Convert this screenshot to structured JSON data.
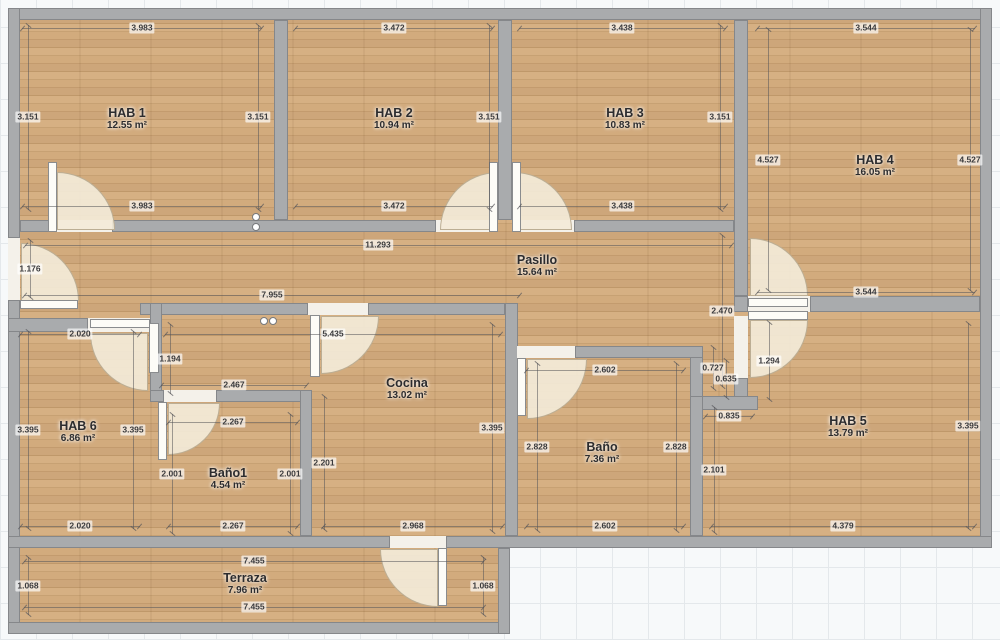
{
  "plan": {
    "title": "Apartment floor plan",
    "units": "m",
    "colors": {
      "wall_gray": "#a9abad",
      "wall_outline": "#85878a",
      "wood_light": "#d6b083",
      "wood_dark": "#bf986a",
      "door_arc_cream": "#f3ead8",
      "grid_line": "#e4e8eb",
      "paper": "#f7f9fa",
      "label_text": "#2c2c2e"
    },
    "rooms": [
      {
        "name": "HAB 1",
        "area": "12.55 m²"
      },
      {
        "name": "HAB 2",
        "area": "10.94 m²"
      },
      {
        "name": "HAB 3",
        "area": "10.83 m²"
      },
      {
        "name": "HAB 4",
        "area": "16.05 m²"
      },
      {
        "name": "Pasillo",
        "area": "15.64 m²"
      },
      {
        "name": "HAB 6",
        "area": "6.86 m²"
      },
      {
        "name": "Baño1",
        "area": "4.54 m²"
      },
      {
        "name": "Cocina",
        "area": "13.02 m²"
      },
      {
        "name": "Baño",
        "area": "7.36 m²"
      },
      {
        "name": "HAB 5",
        "area": "13.79 m²"
      },
      {
        "name": "Terraza",
        "area": "7.96 m²"
      }
    ],
    "dims": [
      {
        "t": "3.983",
        "x": 142,
        "y": 28,
        "o": "h",
        "len": 240
      },
      {
        "t": "3.151",
        "x": 28,
        "y": 117,
        "o": "v",
        "len": 185
      },
      {
        "t": "3.151",
        "x": 258,
        "y": 117,
        "o": "v",
        "len": 185
      },
      {
        "t": "3.983",
        "x": 142,
        "y": 206,
        "o": "h",
        "len": 240
      },
      {
        "t": "3.472",
        "x": 394,
        "y": 28,
        "o": "h",
        "len": 198
      },
      {
        "t": "3.151",
        "x": 489,
        "y": 117,
        "o": "v",
        "len": 185
      },
      {
        "t": "3.472",
        "x": 394,
        "y": 206,
        "o": "h",
        "len": 198
      },
      {
        "t": "3.438",
        "x": 622,
        "y": 28,
        "o": "h",
        "len": 207
      },
      {
        "t": "3.151",
        "x": 720,
        "y": 117,
        "o": "v",
        "len": 185
      },
      {
        "t": "3.438",
        "x": 622,
        "y": 206,
        "o": "h",
        "len": 207
      },
      {
        "t": "3.544",
        "x": 866,
        "y": 28,
        "o": "h",
        "len": 218
      },
      {
        "t": "4.527",
        "x": 768,
        "y": 160,
        "o": "v",
        "len": 262
      },
      {
        "t": "4.527",
        "x": 970,
        "y": 160,
        "o": "v",
        "len": 262
      },
      {
        "t": "3.544",
        "x": 866,
        "y": 292,
        "o": "h",
        "len": 218
      },
      {
        "t": "11.293",
        "x": 378,
        "y": 245,
        "o": "h",
        "len": 707
      },
      {
        "t": "7.955",
        "x": 272,
        "y": 295,
        "o": "h",
        "len": 496
      },
      {
        "t": "1.176",
        "x": 30,
        "y": 269,
        "o": "v",
        "len": 58
      },
      {
        "t": "2.470",
        "x": 722,
        "y": 311,
        "o": "v",
        "len": 152
      },
      {
        "t": "2.020",
        "x": 80,
        "y": 334,
        "o": "h",
        "len": 120
      },
      {
        "t": "3.395",
        "x": 28,
        "y": 430,
        "o": "v",
        "len": 198
      },
      {
        "t": "3.395",
        "x": 133,
        "y": 430,
        "o": "v",
        "len": 198
      },
      {
        "t": "2.020",
        "x": 80,
        "y": 526,
        "o": "h",
        "len": 120
      },
      {
        "t": "1.194",
        "x": 170,
        "y": 359,
        "o": "v",
        "len": 70
      },
      {
        "t": "2.467",
        "x": 234,
        "y": 385,
        "o": "h",
        "len": 146
      },
      {
        "t": "2.267",
        "x": 233,
        "y": 422,
        "o": "h",
        "len": 130
      },
      {
        "t": "2.001",
        "x": 172,
        "y": 474,
        "o": "v",
        "len": 120
      },
      {
        "t": "2.001",
        "x": 290,
        "y": 474,
        "o": "v",
        "len": 120
      },
      {
        "t": "2.267",
        "x": 233,
        "y": 526,
        "o": "h",
        "len": 130
      },
      {
        "t": "5.435",
        "x": 333,
        "y": 334,
        "o": "h",
        "len": 336
      },
      {
        "t": "2.201",
        "x": 324,
        "y": 463,
        "o": "v",
        "len": 134
      },
      {
        "t": "3.395",
        "x": 492,
        "y": 428,
        "o": "v",
        "len": 208
      },
      {
        "t": "2.968",
        "x": 413,
        "y": 526,
        "o": "h",
        "len": 180
      },
      {
        "t": "2.602",
        "x": 605,
        "y": 370,
        "o": "h",
        "len": 158
      },
      {
        "t": "2.828",
        "x": 537,
        "y": 447,
        "o": "v",
        "len": 168
      },
      {
        "t": "2.828",
        "x": 676,
        "y": 447,
        "o": "v",
        "len": 168
      },
      {
        "t": "2.602",
        "x": 605,
        "y": 526,
        "o": "h",
        "len": 158
      },
      {
        "t": "0.727",
        "x": 713,
        "y": 368,
        "o": "v",
        "len": 42
      },
      {
        "t": "0.635",
        "x": 726,
        "y": 379,
        "o": "v",
        "len": 38
      },
      {
        "t": "1.294",
        "x": 769,
        "y": 361,
        "o": "v",
        "len": 78
      },
      {
        "t": "0.835",
        "x": 729,
        "y": 416,
        "o": "h",
        "len": 48
      },
      {
        "t": "2.101",
        "x": 714,
        "y": 470,
        "o": "v",
        "len": 126
      },
      {
        "t": "3.395",
        "x": 968,
        "y": 426,
        "o": "v",
        "len": 206
      },
      {
        "t": "4.379",
        "x": 843,
        "y": 526,
        "o": "h",
        "len": 264
      },
      {
        "t": "7.455",
        "x": 254,
        "y": 561,
        "o": "h",
        "len": 460
      },
      {
        "t": "1.068",
        "x": 28,
        "y": 586,
        "o": "v",
        "len": 58
      },
      {
        "t": "1.068",
        "x": 483,
        "y": 586,
        "o": "v",
        "len": 58
      },
      {
        "t": "7.455",
        "x": 254,
        "y": 607,
        "o": "h",
        "len": 460
      }
    ]
  }
}
